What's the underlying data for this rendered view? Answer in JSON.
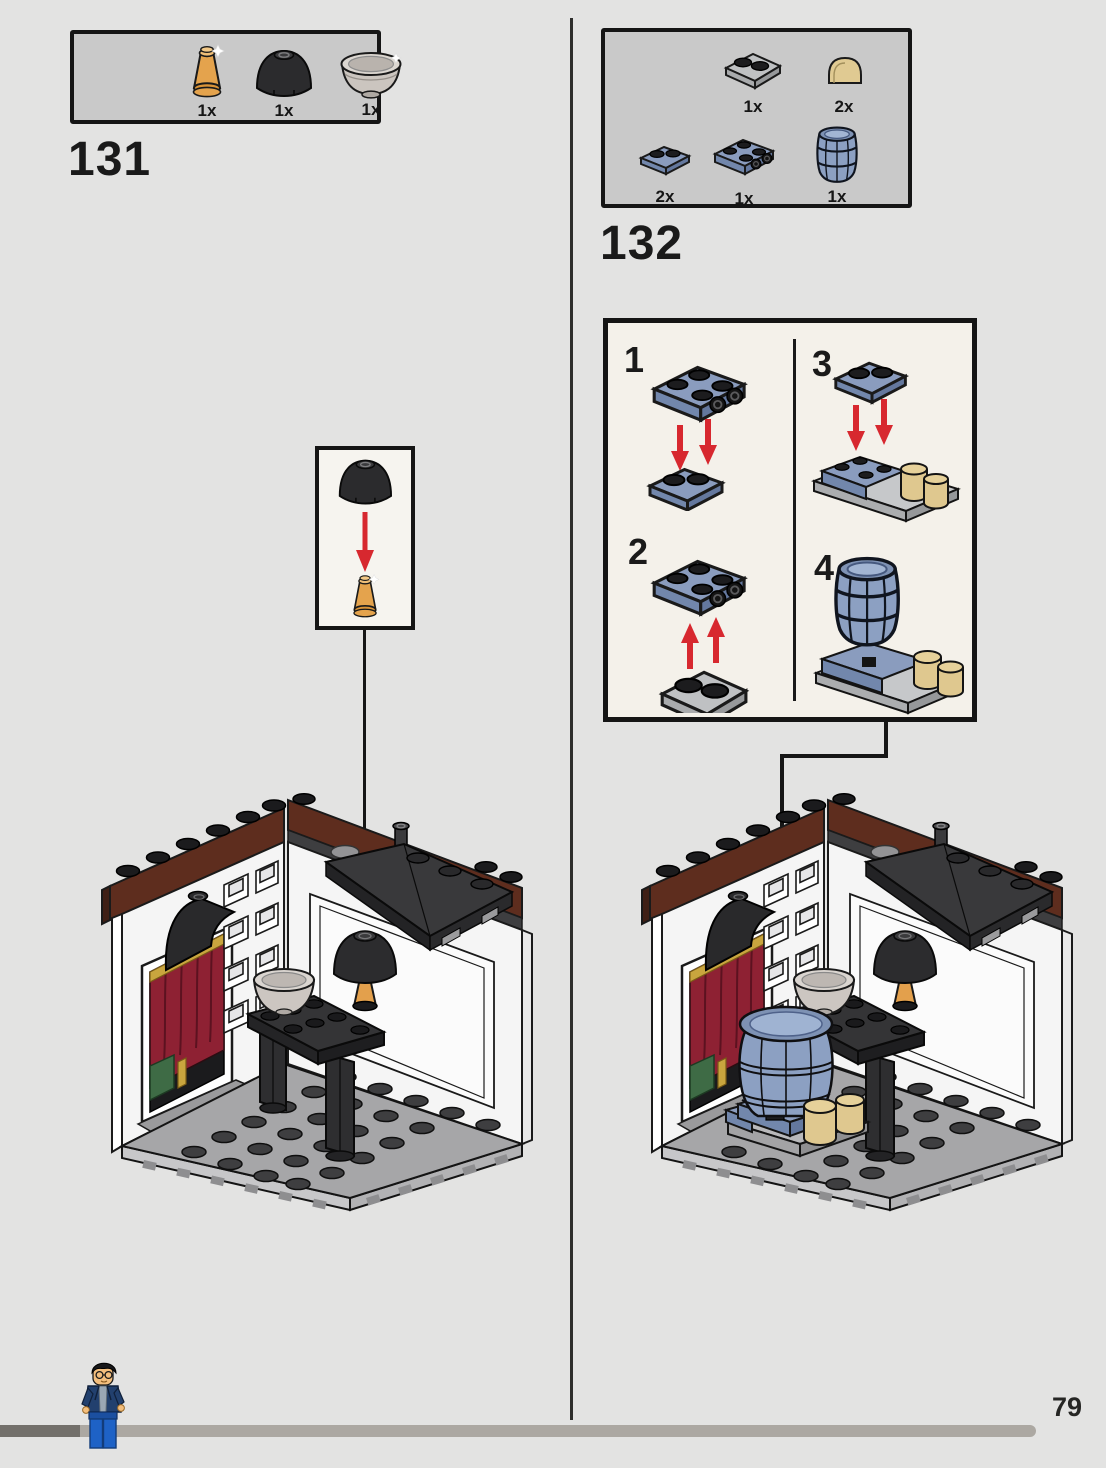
{
  "page": {
    "number": "79"
  },
  "s131": {
    "number": "131",
    "parts": [
      {
        "name": "orange cone 1x1",
        "count": "1x"
      },
      {
        "name": "black dome round brick 2x2",
        "count": "1x"
      },
      {
        "name": "pearl silver bowl dish",
        "count": "1x"
      }
    ]
  },
  "s132": {
    "number": "132",
    "parts": [
      {
        "name": "light gray plate 2x2",
        "count": "1x"
      },
      {
        "name": "tan curved half cylinder brick",
        "count": "2x"
      },
      {
        "name": "sand blue plate 1x2",
        "count": "2x"
      },
      {
        "name": "sand blue bracket plate with side studs",
        "count": "1x"
      },
      {
        "name": "sand blue barrel",
        "count": "1x"
      }
    ]
  },
  "sub": {
    "steps": [
      "1",
      "2",
      "3",
      "4"
    ]
  },
  "colors": {
    "arrow_red": "#d7282f",
    "sand_blue": "#8a9cbe",
    "tan": "#e0ca92",
    "reddish_brown": "#5e2d1e",
    "dark_part_gray": "#2c2c2e",
    "page_bg": "#e3e3e2",
    "parts_box_bg": "#c9c9c9",
    "panel_bg": "#f4f1ea",
    "curtain_red": "#8e2133",
    "curtain_green": "#3e6b45",
    "curtain_gold": "#c9a53e"
  }
}
